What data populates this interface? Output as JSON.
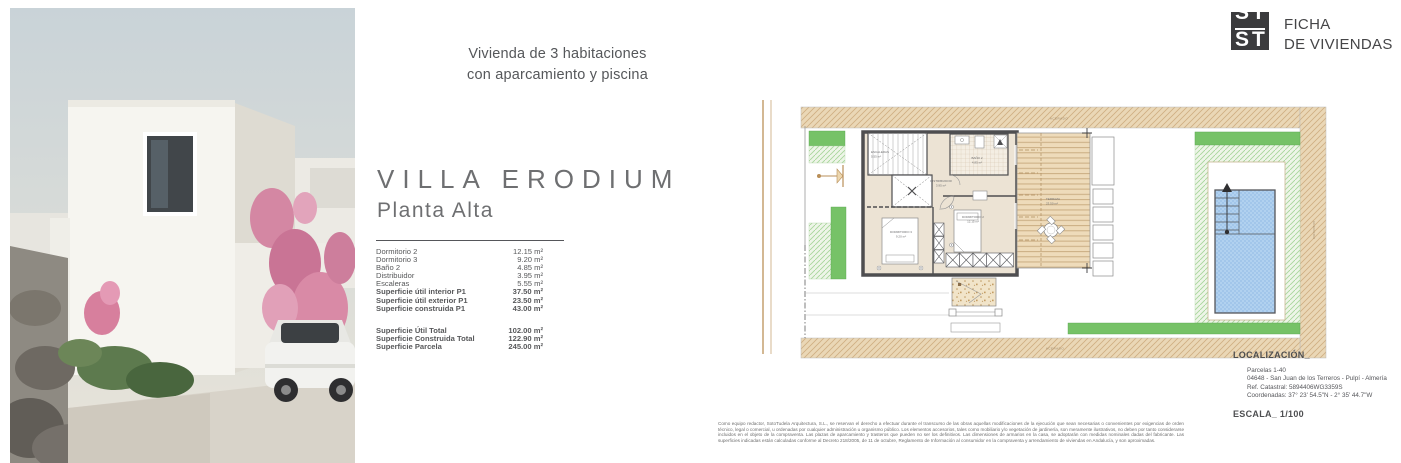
{
  "brand": {
    "logo_top": "ST",
    "logo_bottom": "ST",
    "title_line1": "FICHA",
    "title_line2": "DE VIVIENDAS"
  },
  "intro": {
    "line1": "Vivienda de 3 habitaciones",
    "line2": "con aparcamiento y piscina"
  },
  "villa": {
    "name": "VILLA ERODIUM",
    "floor": "Planta Alta"
  },
  "areas": {
    "rows": [
      {
        "label": "Dormitorio 2",
        "value": "12.15 m²"
      },
      {
        "label": "Dormitorio 3",
        "value": "9.20 m²"
      },
      {
        "label": "Baño 2",
        "value": "4.85 m²"
      },
      {
        "label": "Distribuidor",
        "value": "3.95 m²"
      },
      {
        "label": "Escaleras",
        "value": "5.55 m²"
      },
      {
        "label": "Superficie útil interior P1",
        "value": "37.50 m²"
      },
      {
        "label": "Superficie útil exterior P1",
        "value": "23.50 m²"
      },
      {
        "label": "Superficie construida P1",
        "value": "43.00 m²"
      }
    ],
    "totals": [
      {
        "label": "Superficie Útil Total",
        "value": "102.00 m²"
      },
      {
        "label": "Superficie Construida Total",
        "value": "122.90 m²"
      },
      {
        "label": "Superficie Parcela",
        "value": "245.00 m²"
      }
    ]
  },
  "plan": {
    "rooms": [
      {
        "name": "ESCALERAS",
        "area": "5.55 m²"
      },
      {
        "name": "BAÑO 2",
        "area": "4.85 m²"
      },
      {
        "name": "DISTRIBUIDOR",
        "area": "3.95 m²"
      },
      {
        "name": "DORMITORIO 2",
        "area": "12.15 m²"
      },
      {
        "name": "DORMITORIO 3",
        "area": "9.20 m²"
      },
      {
        "name": "TERRAZA",
        "area": "23.50 m²"
      }
    ],
    "streets": {
      "top": "ACERADO",
      "bottom": "ACERADO",
      "right": "ACERADO"
    }
  },
  "location": {
    "heading": "LOCALIZACIÓN_",
    "lines": [
      "Parcelas 1-40",
      "04648 - San Juan de los Terreros - Pulpí - Almería",
      "Ref. Catastral:  5894406WG3359S",
      "Coordenadas: 37° 23' 54.5\"N - 2° 35' 44.7\"W"
    ],
    "scale": "ESCALA_ 1/100"
  },
  "legal": {
    "text": "Como equipo redactor, SotoTudela Arquitectura, S.L., se reservan el derecho a efectuar durante el transcurso de las obras aquellas modificaciones de la ejecución que sean necesarias o convenientes por exigencias de orden técnico, legal o comercial, u ordenadas por cualquier administración u organismo público. Los elementos accesorios, tales como mobiliario y/o vegetación de jardinería, son meramente ilustrativos, no deben por tanto considerarse incluidos en el objeto de la compraventa. Las plazas de aparcamiento y trasteros que pueden no ser los definitivos. Las dimensiones de armarios en la casa, se adoptarán con medidas nominales dadas del fabricante. Las superficies indicadas están calculadas conforme al Decreto 218/2005, de 11 de octubre, Reglamento de Información al consumidor en la compraventa y arrendamiento de viviendas en Andalucía, y son aproximadas."
  }
}
